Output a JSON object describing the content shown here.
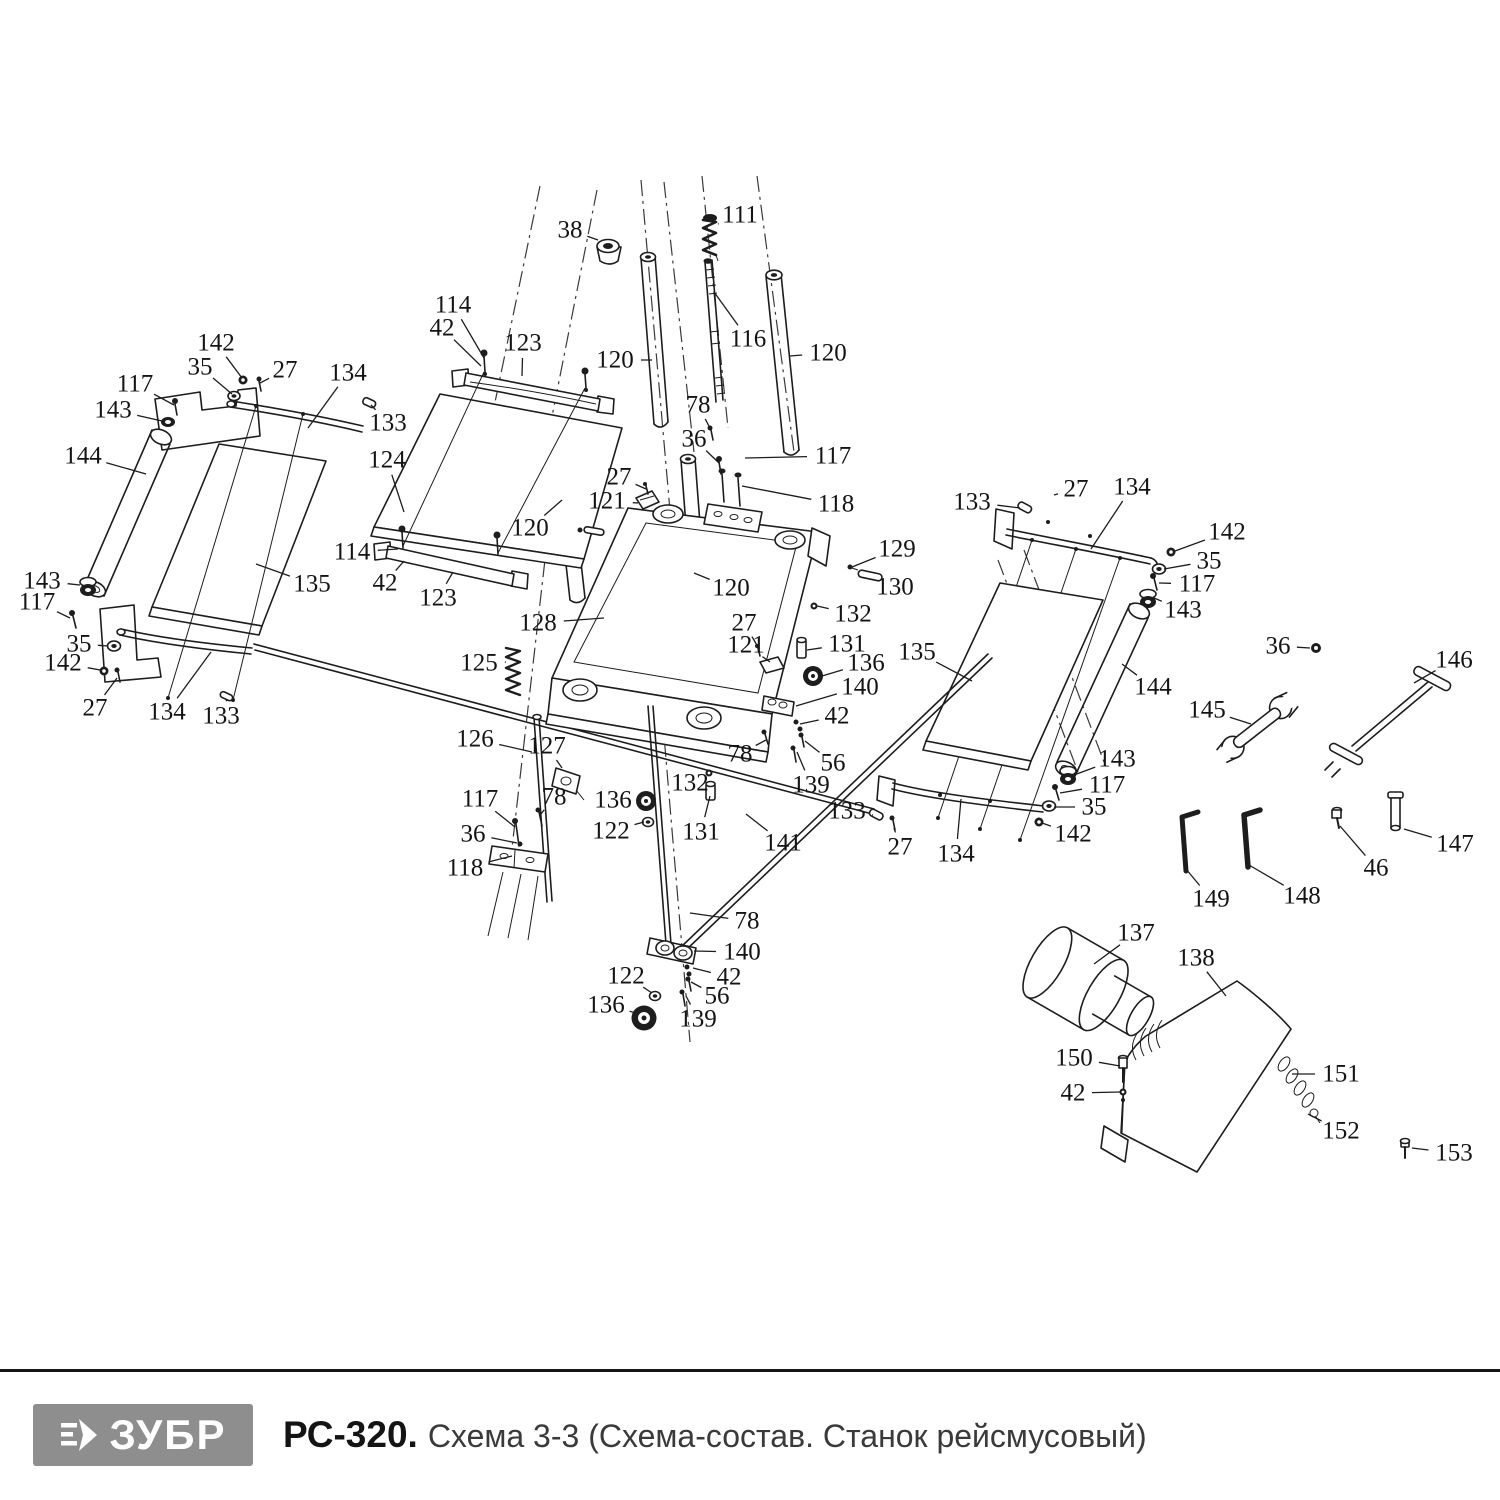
{
  "footer": {
    "brand": "ЗУБР",
    "model": "РС-320.",
    "title": "Схема 3-3 (Схема-состав. Станок рейсмусовый)",
    "logo_color": "#8e8e8e"
  },
  "diagram": {
    "stroke_color": "#1d1d1d",
    "labels": [
      {
        "t": "38",
        "x": 570,
        "y": 230,
        "ex": 598,
        "ey": 240
      },
      {
        "t": "111",
        "x": 740,
        "y": 215,
        "ex": 718,
        "ey": 224
      },
      {
        "t": "114",
        "x": 453,
        "y": 305,
        "ex": 484,
        "ey": 358
      },
      {
        "t": "42",
        "x": 442,
        "y": 328,
        "ex": 481,
        "ey": 366
      },
      {
        "t": "123",
        "x": 523,
        "y": 343,
        "ex": 522,
        "ey": 376
      },
      {
        "t": "120",
        "x": 615,
        "y": 360,
        "ex": 652,
        "ey": 360
      },
      {
        "t": "116",
        "x": 748,
        "y": 339,
        "ex": 714,
        "ey": 292
      },
      {
        "t": "120",
        "x": 828,
        "y": 353,
        "ex": 790,
        "ey": 356
      },
      {
        "t": "78",
        "x": 698,
        "y": 405,
        "ex": 711,
        "ey": 430
      },
      {
        "t": "36",
        "x": 694,
        "y": 439,
        "ex": 719,
        "ey": 463
      },
      {
        "t": "117",
        "x": 833,
        "y": 456,
        "ex": 745,
        "ey": 458
      },
      {
        "t": "118",
        "x": 836,
        "y": 504,
        "ex": 742,
        "ey": 486
      },
      {
        "t": "124",
        "x": 387,
        "y": 460,
        "ex": 404,
        "ey": 512
      },
      {
        "t": "27",
        "x": 619,
        "y": 477,
        "ex": 646,
        "ey": 489
      },
      {
        "t": "121",
        "x": 607,
        "y": 501,
        "ex": 638,
        "ey": 503
      },
      {
        "t": "120",
        "x": 530,
        "y": 528,
        "ex": 562,
        "ey": 500
      },
      {
        "t": "133",
        "x": 388,
        "y": 423,
        "ex": 371,
        "ey": 405
      },
      {
        "t": "134",
        "x": 348,
        "y": 373,
        "ex": 308,
        "ey": 428
      },
      {
        "t": "27",
        "x": 285,
        "y": 370,
        "ex": 260,
        "ey": 383
      },
      {
        "t": "35",
        "x": 200,
        "y": 367,
        "ex": 232,
        "ey": 394
      },
      {
        "t": "142",
        "x": 216,
        "y": 343,
        "ex": 242,
        "ey": 378
      },
      {
        "t": "117",
        "x": 135,
        "y": 384,
        "ex": 174,
        "ey": 405
      },
      {
        "t": "143",
        "x": 113,
        "y": 410,
        "ex": 162,
        "ey": 421
      },
      {
        "t": "144",
        "x": 83,
        "y": 456,
        "ex": 146,
        "ey": 474
      },
      {
        "t": "135",
        "x": 312,
        "y": 584,
        "ex": 256,
        "ey": 564
      },
      {
        "t": "143",
        "x": 42,
        "y": 581,
        "ex": 80,
        "ey": 585
      },
      {
        "t": "117",
        "x": 37,
        "y": 602,
        "ex": 70,
        "ey": 618
      },
      {
        "t": "35",
        "x": 79,
        "y": 644,
        "ex": 108,
        "ey": 646
      },
      {
        "t": "142",
        "x": 63,
        "y": 663,
        "ex": 100,
        "ey": 670
      },
      {
        "t": "27",
        "x": 95,
        "y": 708,
        "ex": 117,
        "ey": 678
      },
      {
        "t": "134",
        "x": 167,
        "y": 712,
        "ex": 211,
        "ey": 652
      },
      {
        "t": "133",
        "x": 221,
        "y": 716,
        "ex": 227,
        "ey": 699
      },
      {
        "t": "114",
        "x": 352,
        "y": 552,
        "ex": 398,
        "ey": 549
      },
      {
        "t": "42",
        "x": 385,
        "y": 583,
        "ex": 404,
        "ey": 561
      },
      {
        "t": "123",
        "x": 438,
        "y": 598,
        "ex": 453,
        "ey": 572
      },
      {
        "t": "128",
        "x": 538,
        "y": 623,
        "ex": 604,
        "ey": 618
      },
      {
        "t": "125",
        "x": 479,
        "y": 663,
        "ex": 506,
        "ey": 662
      },
      {
        "t": "126",
        "x": 475,
        "y": 739,
        "ex": 532,
        "ey": 752
      },
      {
        "t": "127",
        "x": 547,
        "y": 746,
        "ex": 562,
        "ey": 768
      },
      {
        "t": "120",
        "x": 731,
        "y": 588,
        "ex": 694,
        "ey": 573
      },
      {
        "t": "129",
        "x": 897,
        "y": 549,
        "ex": 852,
        "ey": 567
      },
      {
        "t": "130",
        "x": 895,
        "y": 587,
        "ex": 874,
        "ey": 578
      },
      {
        "t": "132",
        "x": 853,
        "y": 614,
        "ex": 817,
        "ey": 606
      },
      {
        "t": "131",
        "x": 847,
        "y": 644,
        "ex": 807,
        "ey": 650
      },
      {
        "t": "136",
        "x": 866,
        "y": 663,
        "ex": 822,
        "ey": 676
      },
      {
        "t": "140",
        "x": 860,
        "y": 687,
        "ex": 796,
        "ey": 706
      },
      {
        "t": "42",
        "x": 837,
        "y": 716,
        "ex": 800,
        "ey": 724
      },
      {
        "t": "27",
        "x": 744,
        "y": 623,
        "ex": 758,
        "ey": 647
      },
      {
        "t": "121",
        "x": 746,
        "y": 645,
        "ex": 770,
        "ey": 662
      },
      {
        "t": "135",
        "x": 917,
        "y": 652,
        "ex": 972,
        "ey": 681
      },
      {
        "t": "133",
        "x": 972,
        "y": 502,
        "ex": 1020,
        "ey": 508
      },
      {
        "t": "27",
        "x": 1076,
        "y": 489,
        "ex": 1054,
        "ey": 495
      },
      {
        "t": "134",
        "x": 1132,
        "y": 487,
        "ex": 1091,
        "ey": 549
      },
      {
        "t": "142",
        "x": 1227,
        "y": 532,
        "ex": 1175,
        "ey": 551
      },
      {
        "t": "35",
        "x": 1209,
        "y": 561,
        "ex": 1164,
        "ey": 569
      },
      {
        "t": "117",
        "x": 1197,
        "y": 584,
        "ex": 1159,
        "ey": 583
      },
      {
        "t": "143",
        "x": 1183,
        "y": 610,
        "ex": 1154,
        "ey": 598
      },
      {
        "t": "144",
        "x": 1153,
        "y": 687,
        "ex": 1122,
        "ey": 664
      },
      {
        "t": "36",
        "x": 1278,
        "y": 646,
        "ex": 1310,
        "ey": 648
      },
      {
        "t": "146",
        "x": 1454,
        "y": 660,
        "ex": 1414,
        "ey": 683
      },
      {
        "t": "145",
        "x": 1207,
        "y": 710,
        "ex": 1251,
        "ey": 724
      },
      {
        "t": "147",
        "x": 1455,
        "y": 844,
        "ex": 1404,
        "ey": 829
      },
      {
        "t": "46",
        "x": 1376,
        "y": 868,
        "ex": 1340,
        "ey": 826
      },
      {
        "t": "149",
        "x": 1211,
        "y": 899,
        "ex": 1186,
        "ey": 869
      },
      {
        "t": "148",
        "x": 1302,
        "y": 896,
        "ex": 1249,
        "ey": 865
      },
      {
        "t": "143",
        "x": 1117,
        "y": 759,
        "ex": 1074,
        "ey": 775
      },
      {
        "t": "117",
        "x": 1107,
        "y": 785,
        "ex": 1060,
        "ey": 793
      },
      {
        "t": "35",
        "x": 1094,
        "y": 807,
        "ex": 1054,
        "ey": 807
      },
      {
        "t": "142",
        "x": 1073,
        "y": 834,
        "ex": 1042,
        "ey": 823
      },
      {
        "t": "27",
        "x": 900,
        "y": 847,
        "ex": 894,
        "ey": 828
      },
      {
        "t": "134",
        "x": 956,
        "y": 854,
        "ex": 961,
        "ey": 799
      },
      {
        "t": "133",
        "x": 847,
        "y": 811,
        "ex": 873,
        "ey": 815
      },
      {
        "t": "78",
        "x": 740,
        "y": 754,
        "ex": 766,
        "ey": 740
      },
      {
        "t": "56",
        "x": 833,
        "y": 763,
        "ex": 805,
        "ey": 741
      },
      {
        "t": "139",
        "x": 811,
        "y": 785,
        "ex": 797,
        "ey": 752
      },
      {
        "t": "141",
        "x": 783,
        "y": 843,
        "ex": 746,
        "ey": 814
      },
      {
        "t": "132",
        "x": 690,
        "y": 783,
        "ex": 707,
        "ey": 774
      },
      {
        "t": "131",
        "x": 701,
        "y": 832,
        "ex": 710,
        "ey": 796
      },
      {
        "t": "117",
        "x": 480,
        "y": 799,
        "ex": 515,
        "ey": 827
      },
      {
        "t": "78",
        "x": 554,
        "y": 797,
        "ex": 541,
        "ey": 814
      },
      {
        "t": "136",
        "x": 613,
        "y": 800,
        "ex": 638,
        "ey": 801
      },
      {
        "t": "36",
        "x": 473,
        "y": 834,
        "ex": 517,
        "ey": 843
      },
      {
        "t": "122",
        "x": 611,
        "y": 831,
        "ex": 644,
        "ey": 822
      },
      {
        "t": "118",
        "x": 465,
        "y": 868,
        "ex": 512,
        "ey": 856
      },
      {
        "t": "78",
        "x": 747,
        "y": 921,
        "ex": 690,
        "ey": 913
      },
      {
        "t": "140",
        "x": 742,
        "y": 952,
        "ex": 694,
        "ey": 951
      },
      {
        "t": "42",
        "x": 729,
        "y": 977,
        "ex": 693,
        "ey": 968
      },
      {
        "t": "122",
        "x": 626,
        "y": 976,
        "ex": 652,
        "ey": 993
      },
      {
        "t": "56",
        "x": 717,
        "y": 996,
        "ex": 691,
        "ey": 982
      },
      {
        "t": "139",
        "x": 698,
        "y": 1019,
        "ex": 686,
        "ey": 996
      },
      {
        "t": "136",
        "x": 606,
        "y": 1005,
        "ex": 636,
        "ey": 1013
      },
      {
        "t": "137",
        "x": 1136,
        "y": 933,
        "ex": 1094,
        "ey": 964
      },
      {
        "t": "138",
        "x": 1196,
        "y": 958,
        "ex": 1226,
        "ey": 996
      },
      {
        "t": "150",
        "x": 1074,
        "y": 1058,
        "ex": 1120,
        "ey": 1066
      },
      {
        "t": "42",
        "x": 1073,
        "y": 1093,
        "ex": 1120,
        "ey": 1092
      },
      {
        "t": "151",
        "x": 1341,
        "y": 1074,
        "ex": 1292,
        "ey": 1074
      },
      {
        "t": "152",
        "x": 1341,
        "y": 1131,
        "ex": 1308,
        "ey": 1114
      },
      {
        "t": "153",
        "x": 1454,
        "y": 1153,
        "ex": 1412,
        "ey": 1148
      }
    ]
  }
}
